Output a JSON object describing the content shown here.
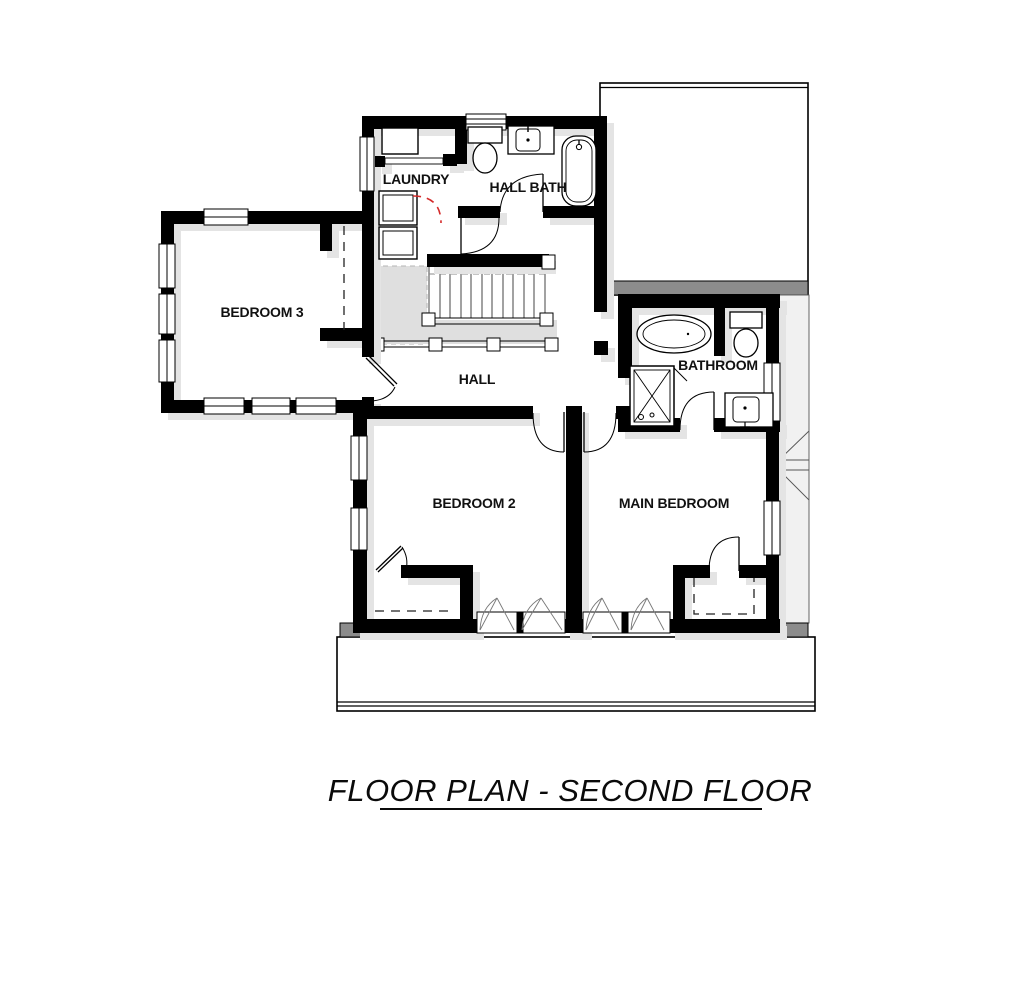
{
  "title": {
    "text": "FLOOR PLAN - SECOND FLOOR"
  },
  "rooms": [
    {
      "id": "laundry",
      "label": "LAUNDRY"
    },
    {
      "id": "hall-bath",
      "label": "HALL BATH"
    },
    {
      "id": "bedroom-3",
      "label": "BEDROOM 3"
    },
    {
      "id": "hall",
      "label": "HALL"
    },
    {
      "id": "bathroom",
      "label": "BATHROOM"
    },
    {
      "id": "bedroom-2",
      "label": "BEDROOM 2"
    },
    {
      "id": "main-bedroom",
      "label": "MAIN BEDROOM"
    }
  ],
  "fixtures": [
    {
      "room": "laundry",
      "items": [
        "counter",
        "washer",
        "dryer"
      ]
    },
    {
      "room": "hall-bath",
      "items": [
        "toilet",
        "sink-vanity",
        "bathtub"
      ]
    },
    {
      "room": "bathroom",
      "items": [
        "bathtub",
        "toilet",
        "shower",
        "sink-vanity"
      ]
    },
    {
      "room": "hall",
      "items": [
        "staircase",
        "railing"
      ]
    }
  ],
  "colors": {
    "wall": "#000000",
    "roof_edge": "#8c8c8c",
    "wall_shadow": "#e4e4e4",
    "stair_landing": "#dfdfdf",
    "accent_door": "#d42a2a",
    "background": "#ffffff"
  }
}
